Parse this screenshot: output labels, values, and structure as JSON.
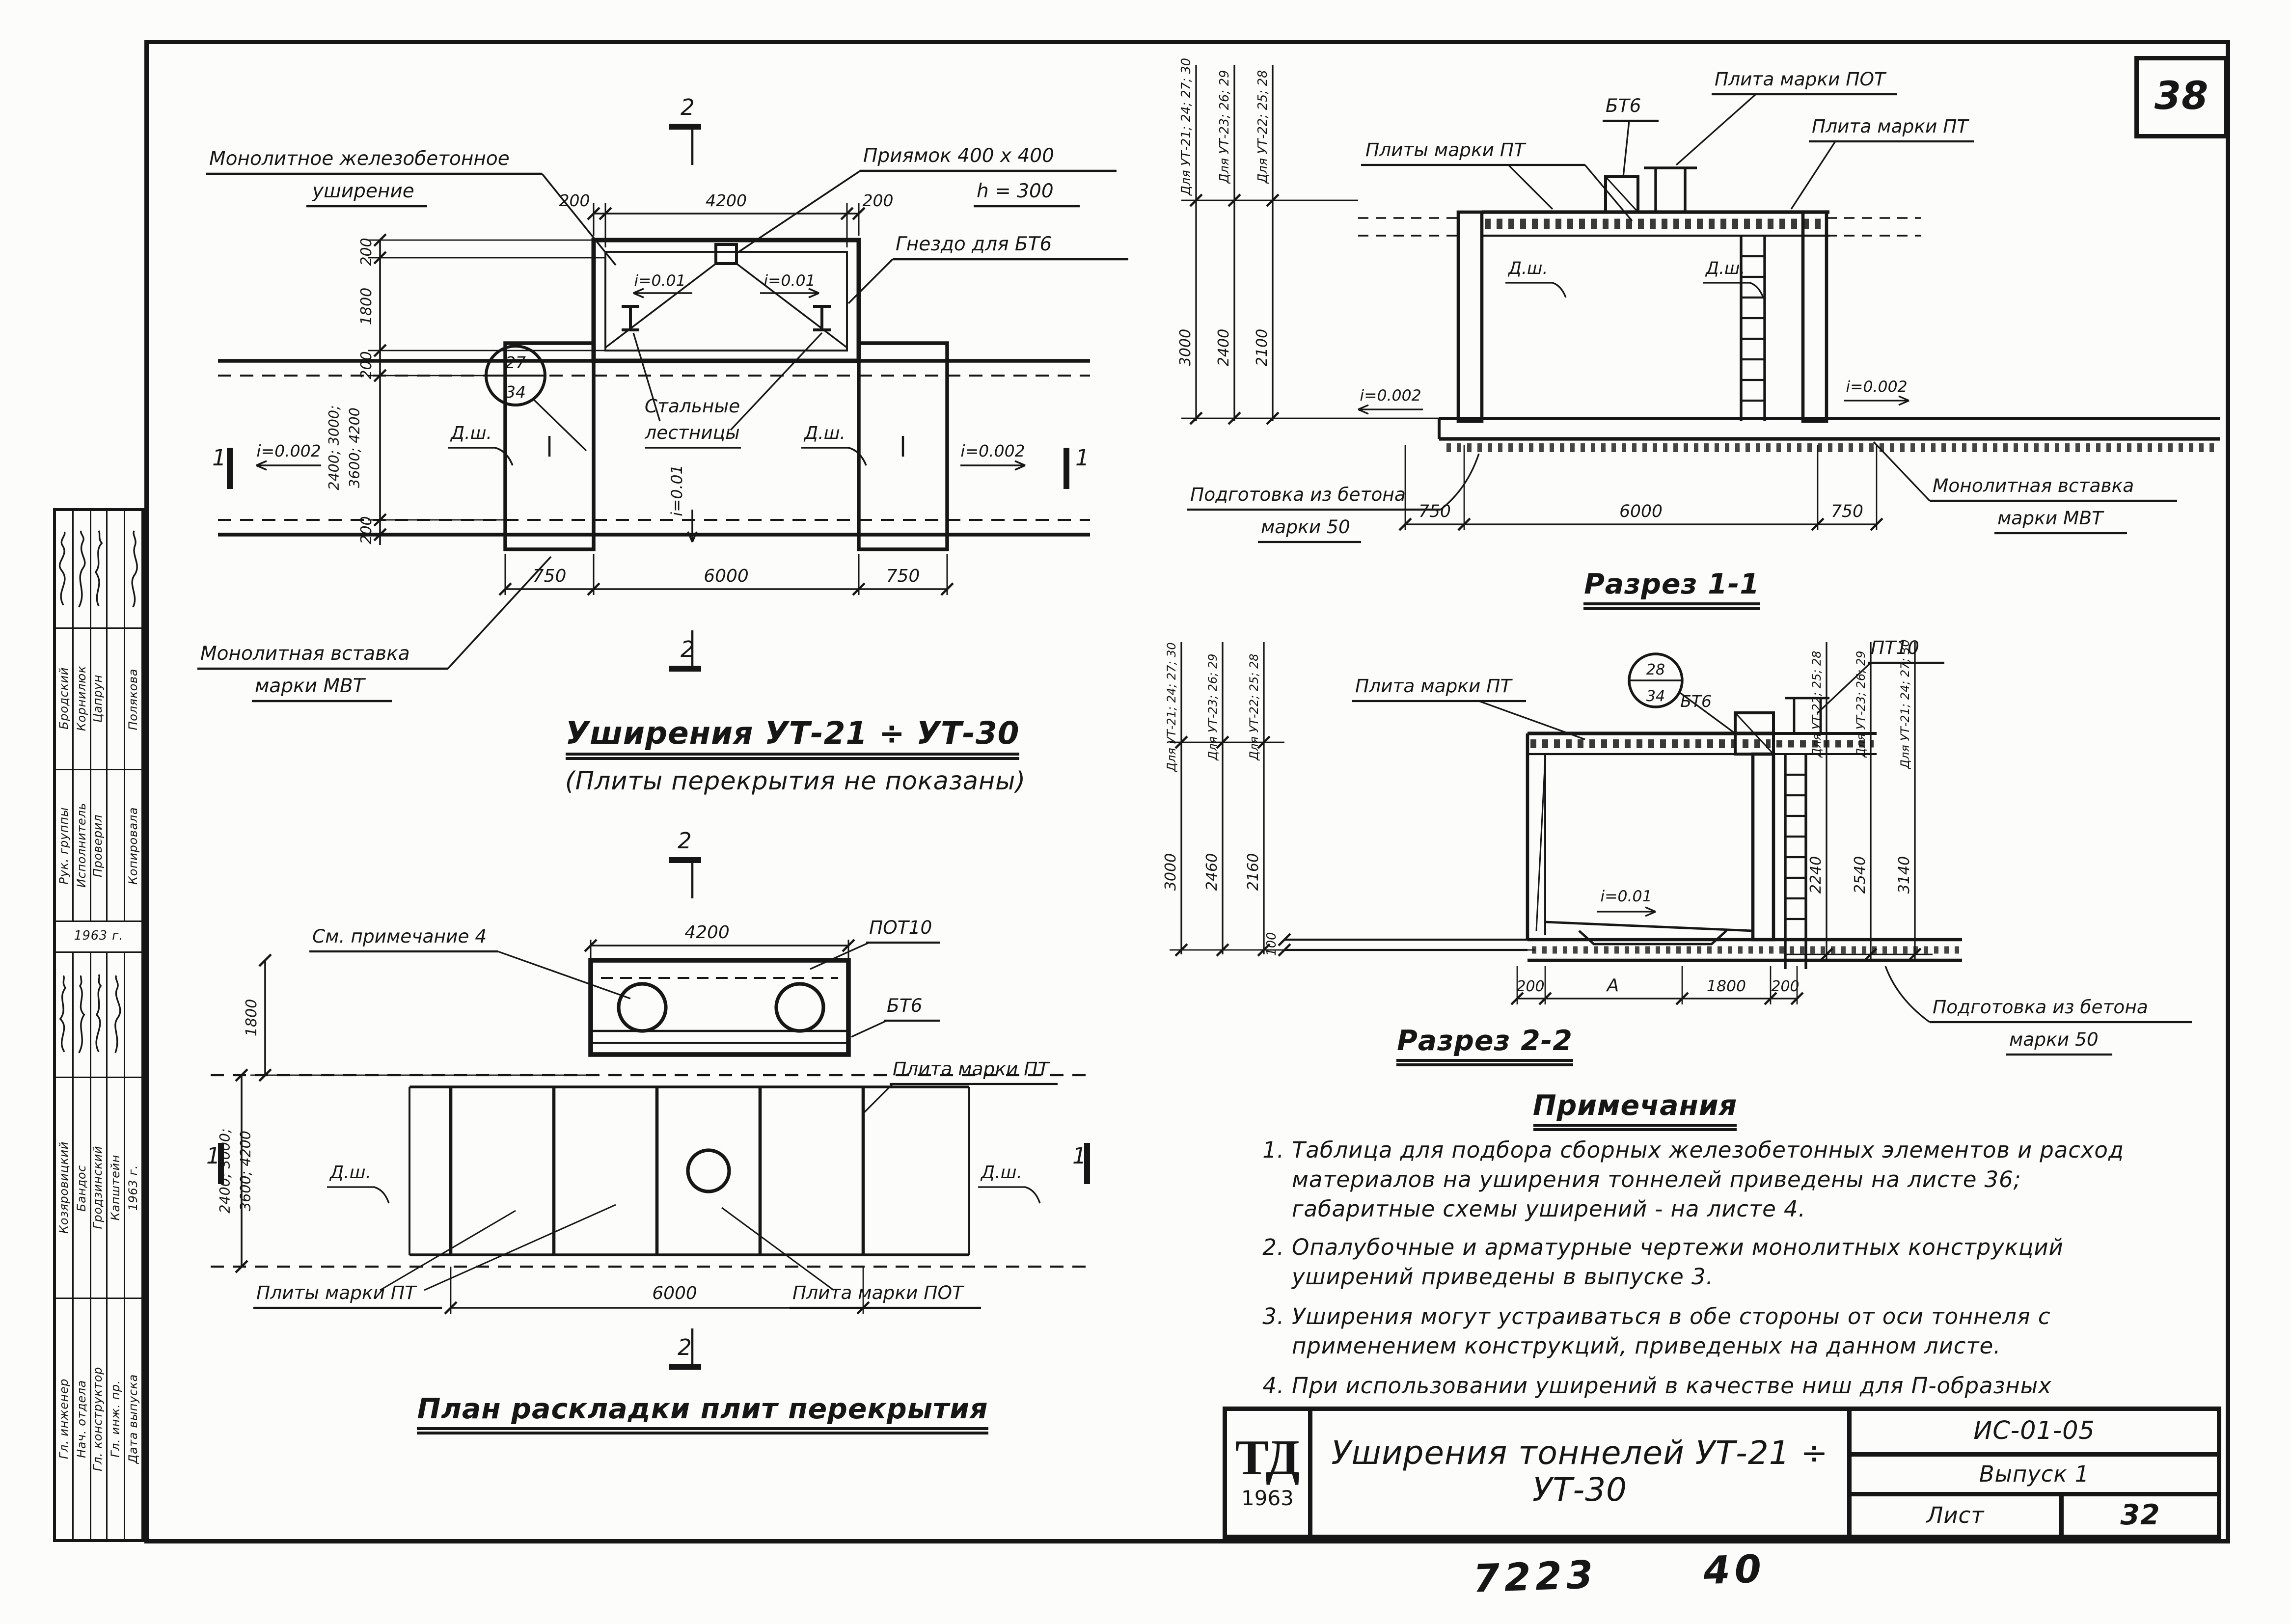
{
  "page": {
    "sheet_corner_number": "38",
    "handwritten_code": "7223",
    "handwritten_number": "40"
  },
  "sidebar": {
    "groupA": {
      "rows": [
        {
          "name": "Бродский",
          "role": "Рук. группы"
        },
        {
          "name": "Корнилюк",
          "role": "Исполнитель"
        },
        {
          "name": "Цапрун",
          "role": "Проверил"
        },
        {
          "name": "",
          "role": ""
        },
        {
          "name": "Полякова",
          "role": "Копировала"
        }
      ],
      "year": "1963 г."
    },
    "groupB": {
      "rows": [
        {
          "name": "Козяровицкий",
          "role": "Гл. инженер"
        },
        {
          "name": "Бандос",
          "role": "Нач. отдела"
        },
        {
          "name": "Гродзинский",
          "role": "Гл. конструктор"
        },
        {
          "name": "Капштейн",
          "role": "Гл. инж. пр."
        },
        {
          "name": "1963 г.",
          "role": "Дата выпуска"
        }
      ]
    }
  },
  "plan": {
    "title": "Уширения  УТ-21 ÷ УТ-30",
    "subtitle": "(Плиты перекрытия не показаны)",
    "label_monolithic_1": "Монолитное железобетонное",
    "label_monolithic_2": "уширение",
    "label_pit": "Приямок 400 х 400",
    "label_pit_h": "h = 300",
    "label_socket": "Гнездо для БТ6",
    "label_ladders_1": "Стальные",
    "label_ladders_2": "лестницы",
    "label_insert_1": "Монолитная вставка",
    "label_insert_2": "марки МВТ",
    "detail_circle_top": "27",
    "detail_circle_bottom": "34",
    "slope_small_left": "i=0.01",
    "slope_small_right": "i=0.01",
    "slope_axis": "i=0.01",
    "slope_left": "i=0.002",
    "slope_right": "i=0.002",
    "dsh_left": "Д.ш.",
    "dsh_right": "Д.ш.",
    "dim_top_left": "200",
    "dim_top_mid": "4200",
    "dim_top_right": "200",
    "dim_bottom_left": "750",
    "dim_bottom_mid": "6000",
    "dim_bottom_right": "750",
    "dim_left_1": "200",
    "dim_left_2": "1800",
    "dim_left_3": "200",
    "dim_left_4": "2400; 3000;",
    "dim_left_5": "3600; 4200",
    "dim_left_6": "200",
    "mark_v": "2",
    "mark_h": "1"
  },
  "slab_plan": {
    "title": "План раскладки плит перекрытия",
    "label_note_ref": "См. примечание 4",
    "label_pot10": "ПОТ10",
    "label_bt6": "БТ6",
    "label_plita_pt": "Плита марки ПТ",
    "label_plity_pt": "Плиты марки ПТ",
    "label_plita_pot": "Плита марки ПОТ",
    "dsh_left": "Д.ш.",
    "dsh_right": "Д.ш.",
    "dim_top": "4200",
    "dim_bottom": "6000",
    "dim_left_1": "1800",
    "dim_left_2": "2400; 3000;",
    "dim_left_3": "3600; 4200",
    "mark_v": "2",
    "mark_h": "1"
  },
  "section11": {
    "title": "Разрез 1-1",
    "col_left_1": "Для УТ-21; 24; 27; 30",
    "col_left_2": "Для УТ-23; 26; 29",
    "col_left_3": "Для УТ-22; 25; 28",
    "dim_col_1": "3000",
    "dim_col_2": "2400",
    "dim_col_3": "2100",
    "label_plity_pt": "Плиты марки ПТ",
    "label_bt6": "БТ6",
    "label_plita_pot": "Плита марки ПОТ",
    "label_plita_pt": "Плита марки ПТ",
    "label_podgotovka_1": "Подготовка из бетона",
    "label_podgotovka_2": "марки 50",
    "label_insert_1": "Монолитная вставка",
    "label_insert_2": "марки МВТ",
    "slope_left": "i=0.002",
    "slope_right": "i=0.002",
    "dsh_left": "Д.ш.",
    "dsh_right": "Д.ш.",
    "dim_bottom_left": "750",
    "dim_bottom_mid": "6000",
    "dim_bottom_right": "750"
  },
  "section22": {
    "title": "Разрез 2-2",
    "col_left_1": "Для УТ-21; 24; 27; 30",
    "col_left_2": "Для УТ-23; 26; 29",
    "col_left_3": "Для УТ-22; 25; 28",
    "dim_left_1": "3000",
    "dim_left_2": "2460",
    "dim_left_3": "2160",
    "col_right_1": "Для УТ-22; 25; 28",
    "col_right_2": "Для УТ-23; 26; 29",
    "col_right_3": "Для УТ-21; 24; 27; 30",
    "dim_right_1": "2240",
    "dim_right_2": "2540",
    "dim_right_3": "3140",
    "label_plita_pt": "Плита марки ПТ",
    "label_bt6": "БТ6",
    "label_pt10": "ПТ10",
    "detail_circle_top": "28",
    "detail_circle_bottom": "34",
    "slope": "i=0.01",
    "label_podgotovka_1": "Подготовка из бетона",
    "label_podgotovka_2": "марки 50",
    "dim_bottom_1": "200",
    "dim_bottom_2": "А",
    "dim_bottom_3": "1800",
    "dim_bottom_4": "200",
    "dim_small": "100"
  },
  "notes": {
    "heading": "Примечания",
    "items": [
      {
        "num": "1.",
        "text": "Таблица для подбора сборных железобетонных элементов и расход материалов на уширения тоннелей приведены на листе 36; габаритные схемы уширений - на листе 4."
      },
      {
        "num": "2.",
        "text": "Опалубочные и арматурные чертежи монолитных конструкций уширений приведены в выпуске 3."
      },
      {
        "num": "3.",
        "text": "Уширения могут устраиваться в обе стороны от оси тоннеля с применением конструкций, приведеных на данном листе."
      },
      {
        "num": "4.",
        "text": "При использовании уширений в качестве ниш для П-образных компенсаторов, люки в перекрытиях не устраиваются."
      }
    ]
  },
  "titleblock": {
    "logo": "ТД",
    "logo_year": "1963",
    "title": "Уширения тоннелей УТ-21 ÷ УТ-30",
    "code": "ИС-01-05",
    "issue": "Выпуск 1",
    "sheet_label": "Лист",
    "sheet_number": "32"
  }
}
